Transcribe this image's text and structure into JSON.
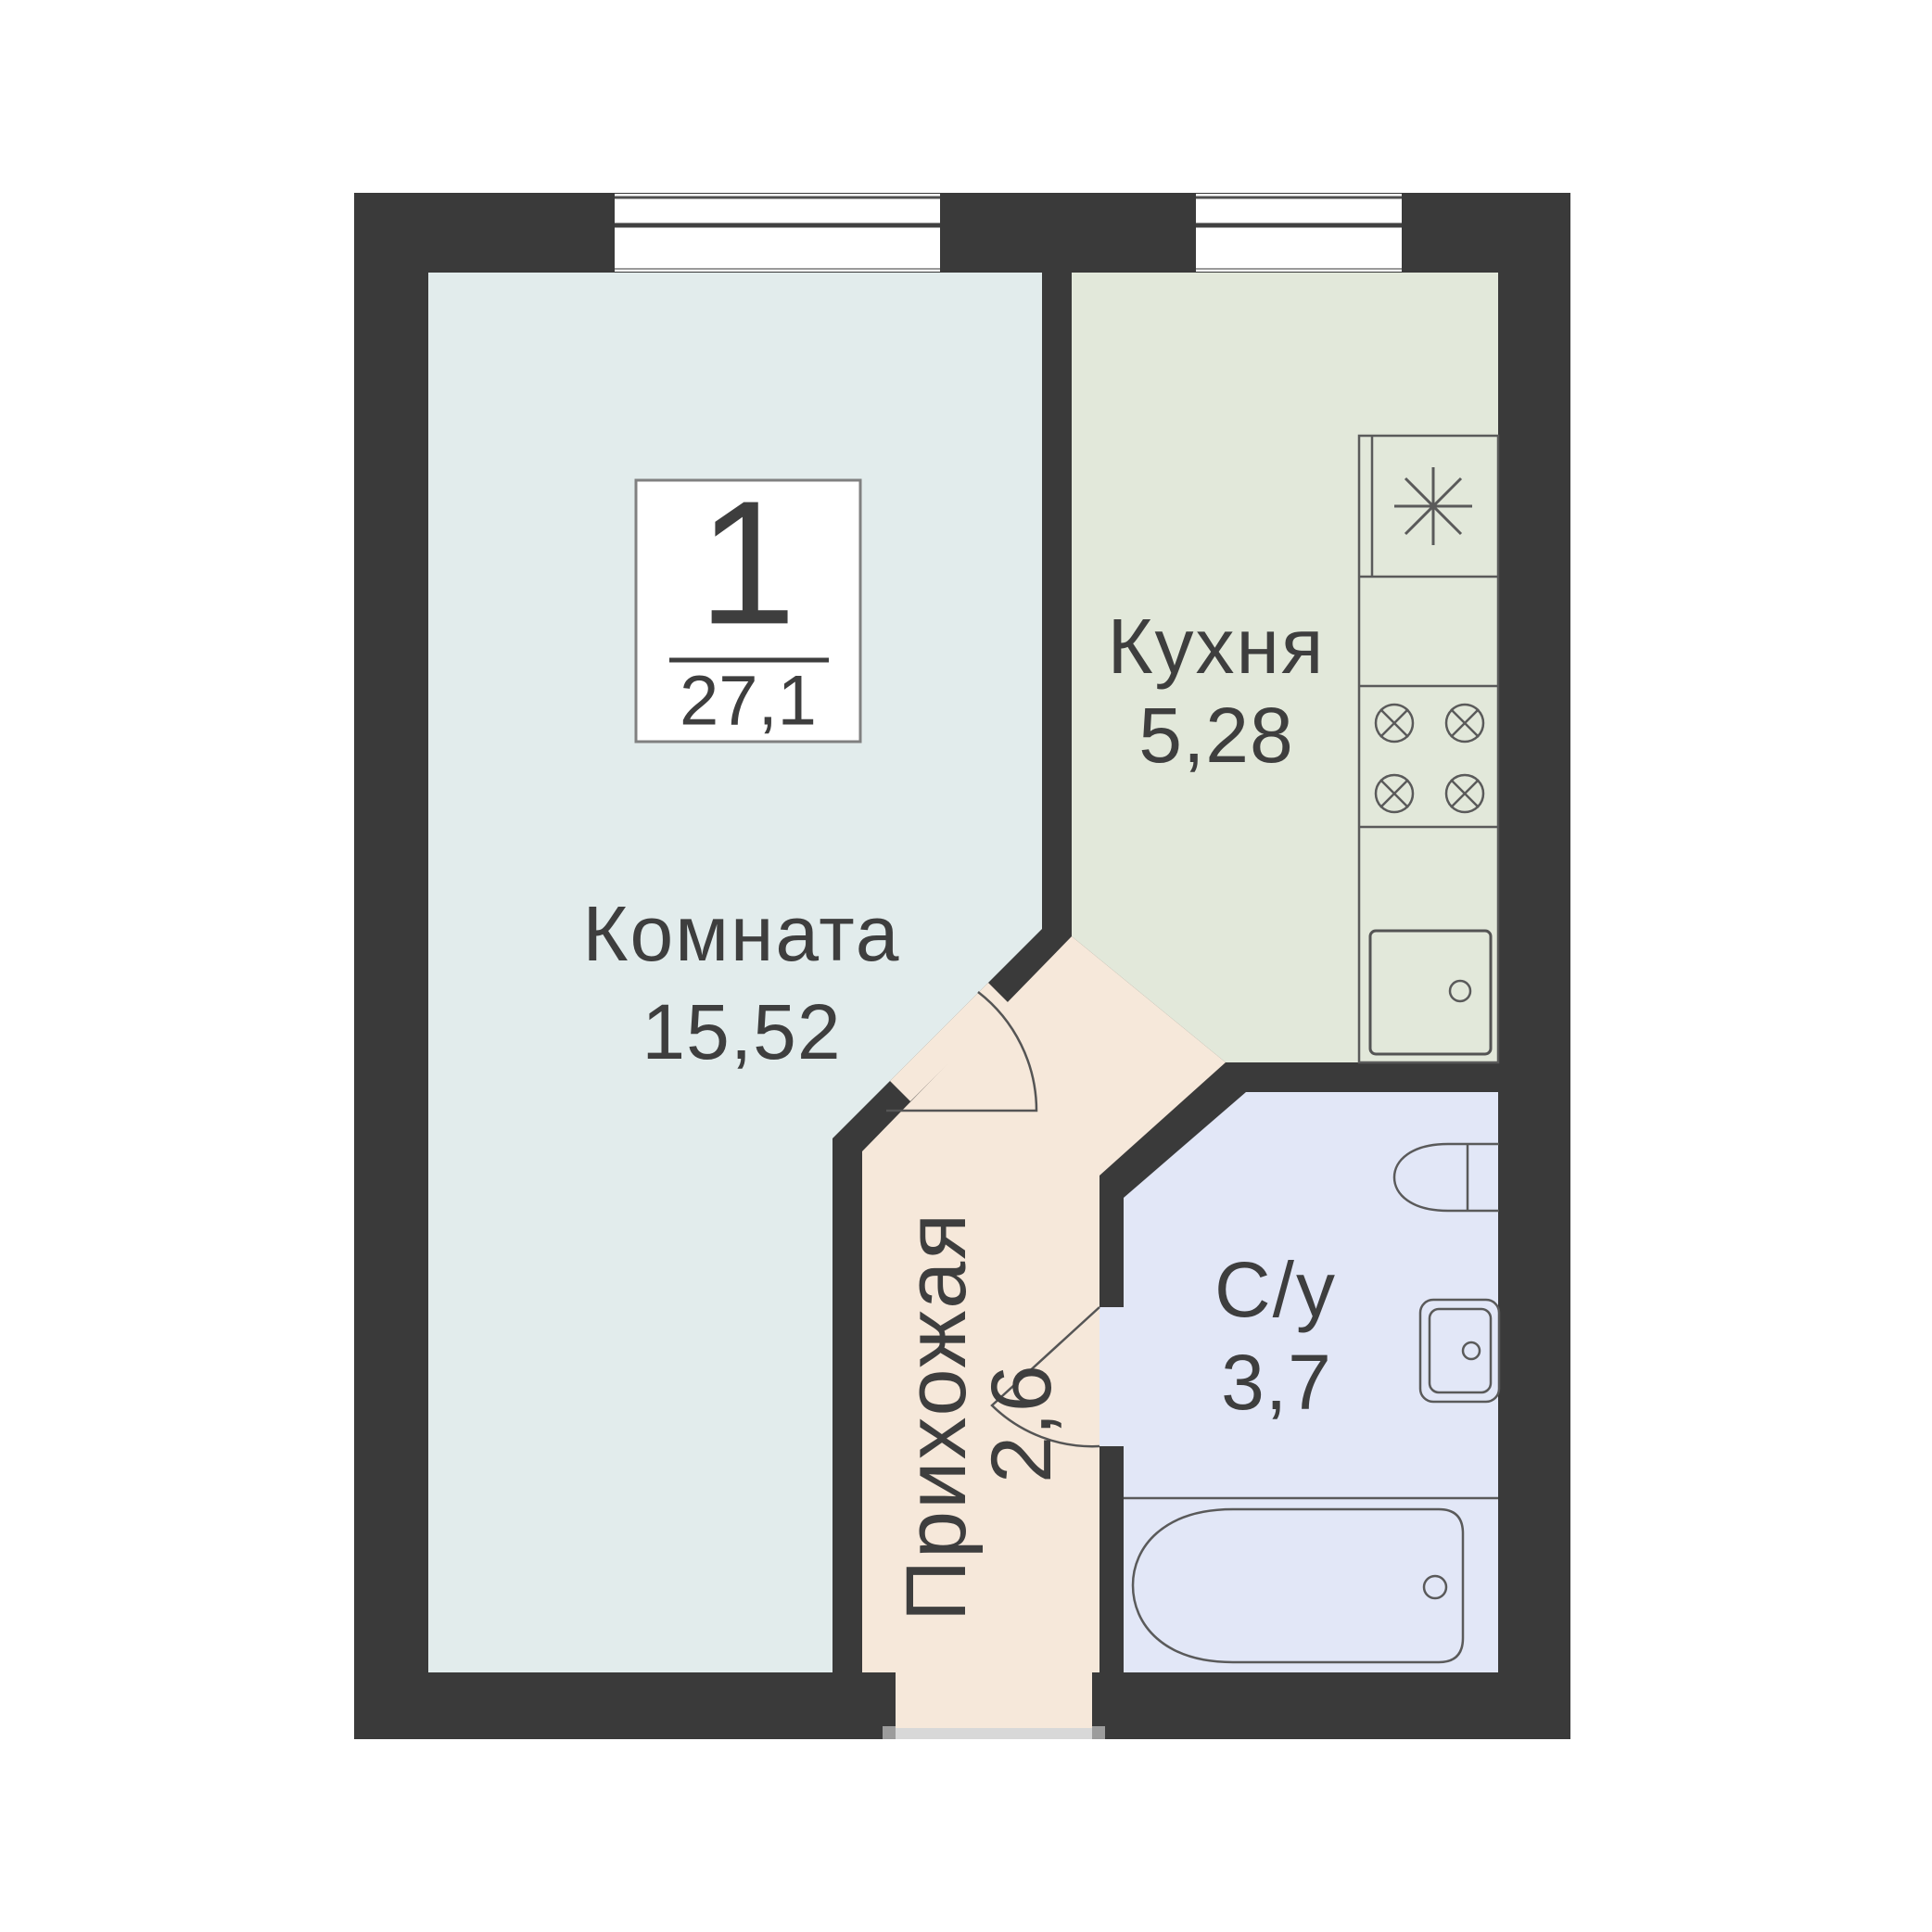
{
  "floorplan": {
    "badge": {
      "rooms_count": "1",
      "total_area": "27,1"
    },
    "rooms": [
      {
        "name": "Комната",
        "area": "15,52",
        "color": "#e2ecec"
      },
      {
        "name": "Кухня",
        "area": "5,28",
        "color": "#e2e8da"
      },
      {
        "name": "Прихожая",
        "area": "2,6",
        "color": "#f6e8da"
      },
      {
        "name": "С/у",
        "area": "3,7",
        "color": "#e2e7f7"
      }
    ],
    "colors": {
      "wall": "#3a3a3a",
      "background": "#ffffff",
      "fixture_stroke": "#545454",
      "text": "#3e3e3e",
      "threshold": "#d8d8d8",
      "threshold_cap": "#9c9c9c",
      "badge_background": "#ffffff",
      "badge_border": "#808080"
    },
    "icons": [
      "window-icon",
      "window-icon",
      "boiler-asterisk-icon",
      "cooktop-burner-icon",
      "kitchen-sink-icon",
      "toilet-icon",
      "washbasin-icon",
      "bathtub-icon",
      "door-swing-arc-icon",
      "door-swing-arc-icon",
      "entrance-threshold"
    ]
  }
}
